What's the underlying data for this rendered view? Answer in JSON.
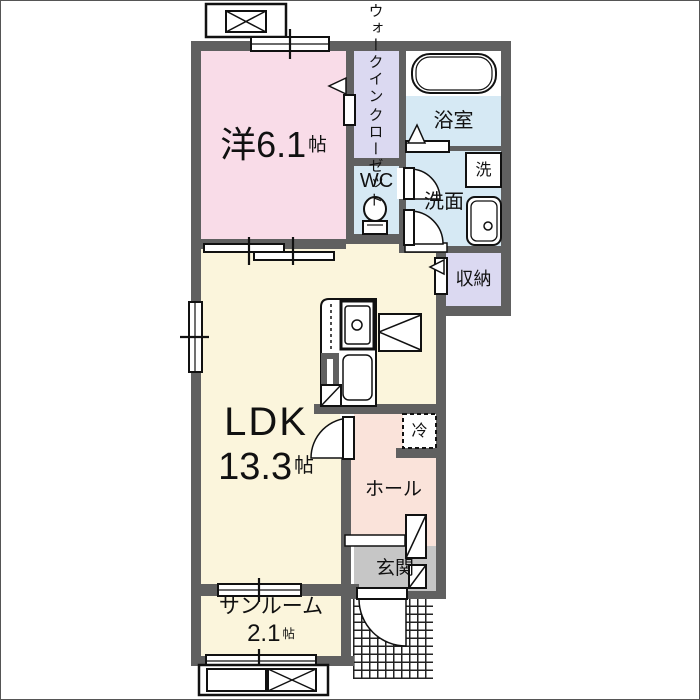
{
  "plan_title": "1LDK apartment floor plan",
  "colors": {
    "wall": "#606060",
    "bedroom_fill": "#f9dce8",
    "closet_fill": "#dbd9f1",
    "wet_area_fill": "#d6e9f4",
    "ldk_fill": "#fbf5dc",
    "hall_fill": "#fae3da",
    "entrance_fill": "#c6c6c6"
  },
  "rooms": {
    "bedroom": {
      "name": "洋",
      "area": "6.1",
      "unit": "帖"
    },
    "closet": {
      "line1": "ウォークイン",
      "line2": "クローゼット"
    },
    "wc": {
      "name": "WC"
    },
    "bath": {
      "name": "浴室"
    },
    "washroom": {
      "name": "洗面"
    },
    "laundry": {
      "name": "洗"
    },
    "storage": {
      "name": "収納"
    },
    "ldk": {
      "name": "LDK",
      "area": "13.3",
      "unit": "帖"
    },
    "fridge": {
      "name": "冷"
    },
    "hall": {
      "name": "ホール"
    },
    "entrance": {
      "name": "玄関"
    },
    "sunroom": {
      "name": "サンルーム",
      "area": "2.1",
      "unit": "帖"
    }
  }
}
